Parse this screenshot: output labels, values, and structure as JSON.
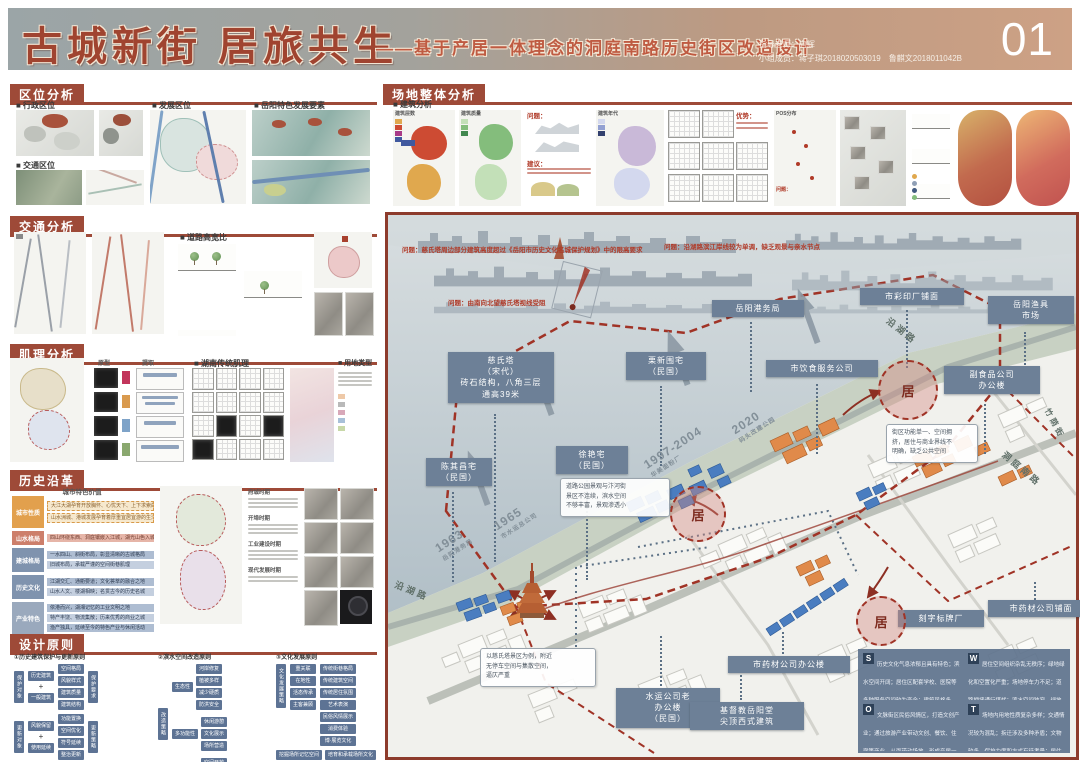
{
  "colors": {
    "accent": "#9e4a38",
    "label_bg": "#6d8097",
    "problem_red": "#a03326",
    "building_blue": "#4a7dc0",
    "building_orange": "#e08a4a"
  },
  "header": {
    "title": "古城新街 居旅共生",
    "subtitle": "——基于产居一体理念的洞庭南路历史街区改造设计",
    "page_no": "01",
    "advisor": "指导老师：向辉",
    "team": "小组成员：蒋子琪2018020503019　鲁麒文2018011042B"
  },
  "loc": {
    "title": "区位分析",
    "l1": "■ 行政区位",
    "l2": "■ 发展区位",
    "l3": "■ 岳阳特色发展要素",
    "l4": "■ 交通区位"
  },
  "traffic": {
    "title": "交通分析",
    "l1": "■ 道路高宽比"
  },
  "texture": {
    "title": "肌理分析",
    "l1": "原型",
    "l2": "提取",
    "l3": "■ 湖南传统肌理",
    "l4": "■ 用地类型"
  },
  "history": {
    "title": "历史沿革",
    "table_title": "城市特色价值",
    "rows": [
      {
        "label": "城市性质",
        "l1": "大江大湖孕育开放胸怀、心忧天下、上下求索的精神内涵",
        "l2": "山水洲城、港城发展孕育着厚重宜居宜游的生活状态"
      },
      {
        "label": "山水格局",
        "l1": "四山环绕东西、洞庭镶嵌入江城，湖光山色入城郭",
        "l2": ""
      },
      {
        "label": "建城格局",
        "l1": "一水四山、斜街布局，彰显清晰的古城格局",
        "l2": "旧城布局，承载严谨的空间街巷肌理"
      },
      {
        "label": "历史文化",
        "l1": "江湖交汇、通衢要道；文化荟萃的融合之地",
        "l2": "山水人文、楼湖相映；名贯古今的历史名城"
      },
      {
        "label": "产业特色",
        "l1": "依港而兴，湖湘记忆的工业文明之地",
        "l2": "特产丰饶、物流集散；历来优秀的商业之城",
        "l3": "渔产独具，延续至今的特色产业与休闲活动"
      }
    ],
    "groups": [
      "府城时期",
      "开埠时期",
      "工业建设时期",
      "现代发展时期"
    ]
  },
  "principles": {
    "title": "设计原则",
    "plus": "+",
    "c1": {
      "title": "①历史建筑保护与更新原则",
      "g1_left": "保护对象",
      "g1_in": [
        "历史建筑",
        "一般建筑"
      ],
      "g1_mid": [
        "空间格局",
        "风貌样式",
        "建筑质量",
        "建筑结构"
      ],
      "g1_right": "保护要求",
      "g2_left": "更新对象",
      "g2_in": [
        "风貌保留",
        "使用延续"
      ],
      "g2_mid": [
        "功能置换",
        "空间优化",
        "符号延续",
        "整治更新"
      ],
      "g2_right": "更新策略"
    },
    "c2": {
      "title": "②滨水空间改造原则",
      "root": "改造策略",
      "b1": "生态性",
      "b1_items": [
        "河岸修复",
        "植被多样",
        "减少硬质",
        "防洪安全"
      ],
      "b2": "多功能性",
      "b2_items": [
        "休闲游憩",
        "文化展示",
        "场所营造"
      ],
      "b3": "可达宜性",
      "b3_items": [
        "空间开放",
        "游线组织"
      ]
    },
    "c3": {
      "title": "③文化发展原则",
      "root": "文化发展策略",
      "branches": [
        "重关联",
        "在地性",
        "活态传承",
        "主客兼顾"
      ],
      "items": [
        "传统街巷格局",
        "传统建筑空间",
        "传统居住氛围",
        "艺术表演",
        "民俗风情展示",
        "消费体验",
        "博·展览文化"
      ],
      "bottom": [
        "挖掘场所记忆空间",
        "培育和承载场所文化"
      ]
    }
  },
  "site": {
    "title": "场地整体分析",
    "sub": "■ 建筑分析",
    "lg1": "建筑层数",
    "lg2": "建筑质量",
    "lg3": "建筑年代",
    "pos": "POS分布",
    "problem": "问题：",
    "advice": "建议：",
    "strength": "优势：",
    "lg1_colors": [
      "#e0a84e",
      "#cd4b33",
      "#a83a87",
      "#40599f"
    ],
    "lg2_colors": [
      "#c3e0b8",
      "#84bd7c",
      "#41874e"
    ],
    "lg3_colors": [
      "#d3d8ee",
      "#93a1d2",
      "#32406e"
    ]
  },
  "map": {
    "problems": {
      "p1": "问题：慈氏塔周边部分建筑高度超过《岳阳市历史文化名城保护规划》中的限高要求",
      "p2": "问题：由南向北望慈氏塔视线受阻",
      "p3": "问题：沿湖路滨江岸线较为单调，缺乏观景与亲水节点"
    },
    "labels": {
      "cishita": "慈氏塔\n（宋代）\n砖石结构，八角三层\n通高39米",
      "lixin": "栗新围宅\n（民国）",
      "gangwu": "岳阳港务局",
      "caiyin": "市彩印厂铺面",
      "yuju": "岳阳渔具\n市场",
      "yinshi": "市饮食服务公司",
      "fushipin": "副食品公司\n办公楼",
      "xuyan": "徐艳宅\n（民国）",
      "chenqichang": "陈其昌宅\n（民国）",
      "shuiyun": "水运公司老\n办公楼\n（民国）",
      "jidujiao": "基督教岳阳堂\n尖顶西式建筑",
      "yaocai_office": "市药材公司办公楼",
      "yaocai_shop": "市药材公司铺面",
      "kezi": "刻字标牌厂"
    },
    "streets": {
      "yanhu1": "沿湖路",
      "yanhu2": "沿湖路",
      "dongting": "洞庭南路",
      "zhuyin": "竹荫街"
    },
    "years": {
      "y1": "1963",
      "y1s": "岳阳港务局",
      "y2": "1965",
      "y2s": "市水运总公司",
      "y3": "1997-2004",
      "y3s": "华美面粉厂",
      "y4": "2020",
      "y4s": "码头改建公园"
    },
    "bubbles": {
      "b1": "道路公园景观与汴河街\n景区不连续，滨水空间\n不够丰富，景观渗透小",
      "b2": "以慈氏塔景区为例，附近\n无停车空间与集散空间，\n逼仄严重",
      "b3": "街区功能单一、空间拥\n挤，居住与商业界线不\n明确，缺乏公共空间"
    },
    "circle_label": "居",
    "swot": {
      "s_k": "S",
      "w_k": "W",
      "o_k": "O",
      "t_k": "T",
      "s": "历史文化气息浓郁且具有特色；滨水空间开阔；居住区配套学校、医院等多种服务空间较为齐全；建筑风格多样，自带旅游景点",
      "w": "居住空间组织杂乱无秩序；绿地绿化和空置化严重；场地停车力不足；道路拥堵通行堪忧；滨水空间狭窄、绿地较少",
      "o": "文脉街区民俗风情区，打造文创产业；通过旅游产业带动文创、餐饮、住宿等商业，从而带动场地，形成产居一体化空间",
      "t": "场地内用地性质复杂多样；交通情况较为混乱；拆迁涉及多种矛盾；文物较多，保护力度和方式有待考量；居住与商业的部分冲突亟需控制"
    }
  }
}
